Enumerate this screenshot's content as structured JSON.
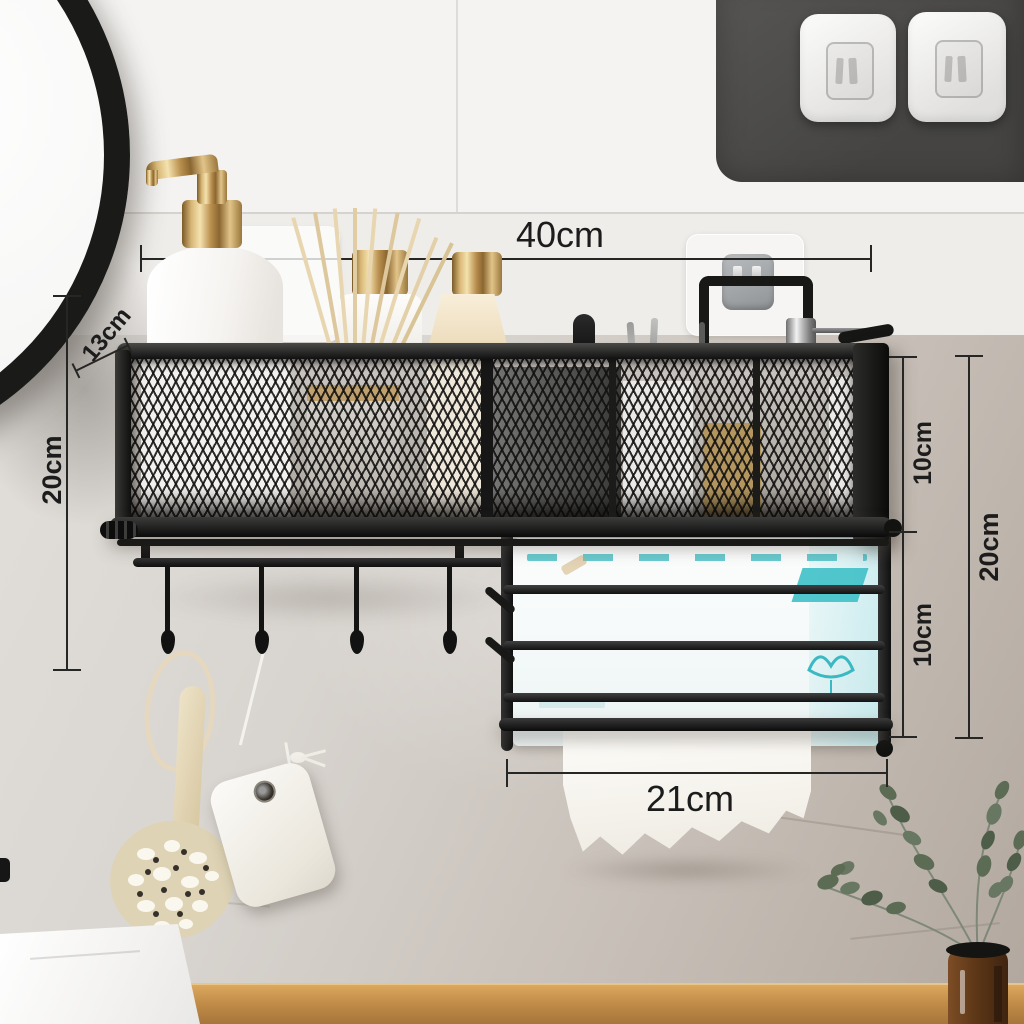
{
  "dimensions": {
    "top_width": {
      "label": "40cm"
    },
    "depth": {
      "label": "13cm"
    },
    "left_height": {
      "label": "20cm"
    },
    "right_upper": {
      "label": "10cm"
    },
    "right_lower": {
      "label": "10cm"
    },
    "right_total": {
      "label": "20cm"
    },
    "bottom_width": {
      "label": "21cm"
    }
  },
  "palette": {
    "metal_black": "#151514",
    "wall_tile": "#f4f3f1",
    "wall_marble": "#c6beb6",
    "wood_ledge": "#c18c48",
    "gold_accent": "#d9b878",
    "tissue_teal": "#4ec3c9",
    "mount_panel_gray": "#4e4d4b"
  }
}
